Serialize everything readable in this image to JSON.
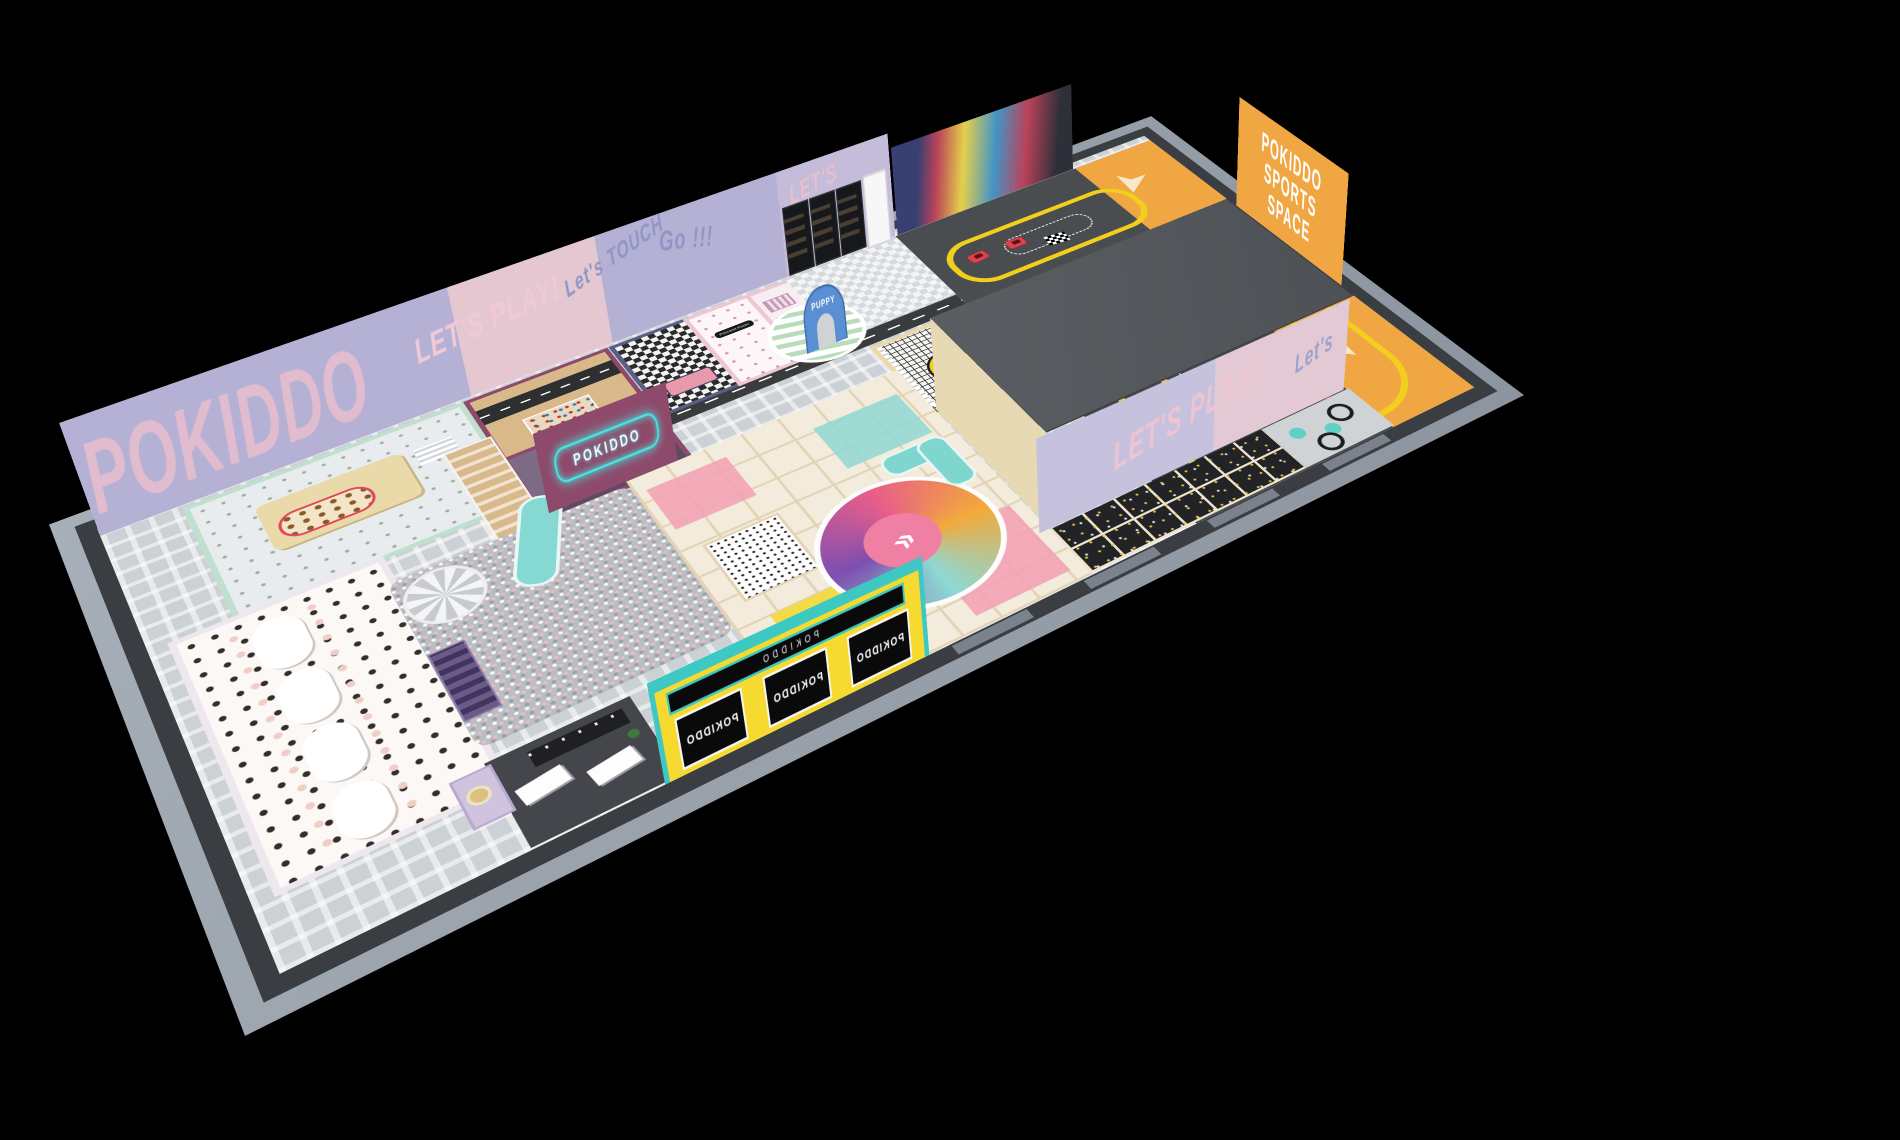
{
  "scene": {
    "description": "3D isometric render of POKIDDO indoor playground floor plan on black background",
    "background": "#000000"
  },
  "texts": {
    "brand_big": "POKIDDO",
    "lets_play": "LET'S PLAY!",
    "lets": "LET'S",
    "lets_touch": "Let's TOUCH",
    "go": "Go !!!",
    "neon_sign": "POKIDDO",
    "puppy_arch": "PUPPY",
    "princess_sign": "Princess Room",
    "sports_banner": {
      "line1": "POKIDDO",
      "line2": "SPORTS",
      "line3": "SPACE"
    },
    "entrance_window": "POKIDDO",
    "marquee": "POKIDDO",
    "tramp_lets_play": "LET'S PLAY!",
    "tramp_lets": "Let's"
  },
  "palette": {
    "background": "#000000",
    "slab_edge": "#99a1ab",
    "wall_dark": "#3a3d41",
    "floor_base": "#ccd1d5",
    "orange_floor": "#f0a743",
    "barrier_yellow": "#f2cf1d",
    "track_gray": "#4a4d50",
    "roof_gray": "#55585c",
    "ballpit_pink": "#eebac2",
    "mint": "#bfe0cf",
    "maroon": "#8e4a6a",
    "navy": "#5b5e86",
    "lavender_wall": "#b7b3d8",
    "graffiti_pink": "#edbecd",
    "sand_beige": "#ead9a9",
    "entrance_yellow": "#f6da2f",
    "teal": "#3ec8c4",
    "dining_floor": "#fbf8f5",
    "softplay_cream": "#f3ecdc",
    "trampoline_black": "#222326",
    "kart_red": "#d9454f"
  },
  "zone_names": [
    "dining-area",
    "kitchen-role-play",
    "party-room-road",
    "party-room-neon",
    "role-play-street",
    "vending-corner",
    "sand-excavator-zone",
    "go-kart-track",
    "ball-pit",
    "soft-play-structure",
    "trampoline-zone",
    "ninja-ball-zone",
    "reception-lounge",
    "entrance-ticket-booth",
    "equipment-roof-block"
  ]
}
